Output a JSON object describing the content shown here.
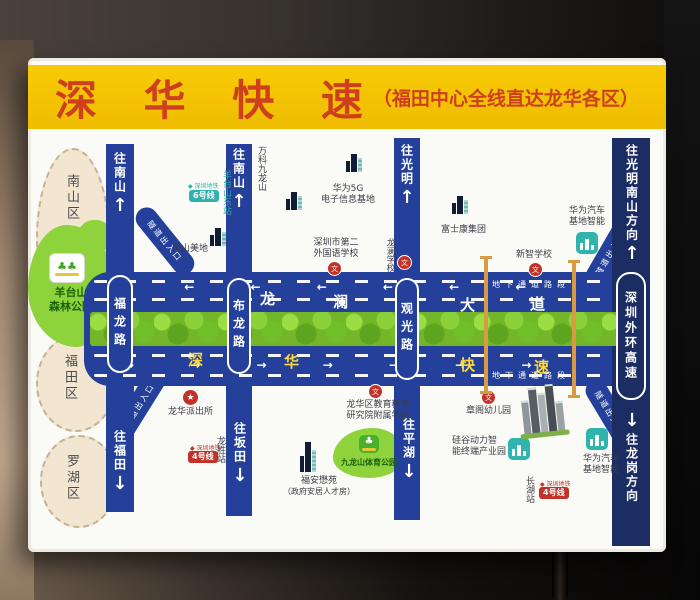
{
  "banner": {
    "title": "深 华 快 速",
    "subtitle": "（福田中心全线直达龙华各区）"
  },
  "districts": {
    "nanshan": "南山区",
    "futian": "福田区",
    "luohu": "罗湖区"
  },
  "parks": {
    "yangtaishan_line1": "羊台山",
    "yangtaishan_line2": "森林公园",
    "jiulongshan": "九龙山体育公园"
  },
  "main_road": {
    "top_name": [
      "龙",
      "澜",
      "大",
      "道"
    ],
    "bottom_name": [
      "深",
      "华",
      "快",
      "速"
    ],
    "tunnel_label": "地下通道路段",
    "ramp_label": "隧道出入口"
  },
  "roads": {
    "fulong": "福龙路",
    "bulong": "布龙路",
    "guanguang": "观光路",
    "outer_ring": "深圳外环高速"
  },
  "directions": {
    "to_nanshan_a": "往南山",
    "to_nanshan_b": "往南山",
    "to_guangming": "往光明",
    "to_futian": "往福田",
    "to_bantian": "往坂田",
    "to_pinghu": "往平湖",
    "to_guangming_nanshan": "往光明南山方向",
    "to_longgang": "往龙岗方向"
  },
  "metro": {
    "operator": "深圳地铁",
    "line6_badge": "6号线",
    "line4_badge": "4号线",
    "station_yangtaishan_east": "羊台山东站",
    "station_longsheng": "龙胜站",
    "station_changhu": "长湖站"
  },
  "landmarks": {
    "vanke": "万科九龙山",
    "huawei5g_line1": "华为5G",
    "huawei5g_line2": "电子信息基地",
    "youshan": "优山美地",
    "sfls_line1": "深圳市第二",
    "sfls_line2": "外国语学校",
    "longlan_school": "龙澜学校",
    "foxconn": "富士康集团",
    "xinzhi_school": "新智学校",
    "huawei_auto_line1": "华为汽车",
    "huawei_auto_line2": "基地智能",
    "police": "龙华派出所",
    "edu_line1": "龙华区教育科学",
    "edu_line2": "研究院附属学校",
    "fuan_line1": "福安懋苑",
    "fuan_line2": "（政府安居人才房）",
    "zhangge": "章阁幼儿园",
    "silicon_line1": "硅谷动力智",
    "silicon_line2": "能终端产业园"
  },
  "icons": {
    "arrow_up": "↑",
    "arrow_down": "↓",
    "lane_arrows_left": "← ← ← ← ← ← ←",
    "lane_arrows_right": "→ → → → → → →",
    "school_badge": "文",
    "police_star": "★",
    "metro_logo": "◆",
    "tree": "♣",
    "trees": "♣♣"
  },
  "colors": {
    "banner_yellow": "#f5c60a",
    "title_red": "#ce3f1e",
    "road_blue": "#24409a",
    "expressway_navy": "#1b2d63",
    "median_green": "#74b629",
    "metro_teal": "#2fb2ad",
    "badge_red": "#c03328",
    "tunnel_orange": "#d89b43"
  }
}
